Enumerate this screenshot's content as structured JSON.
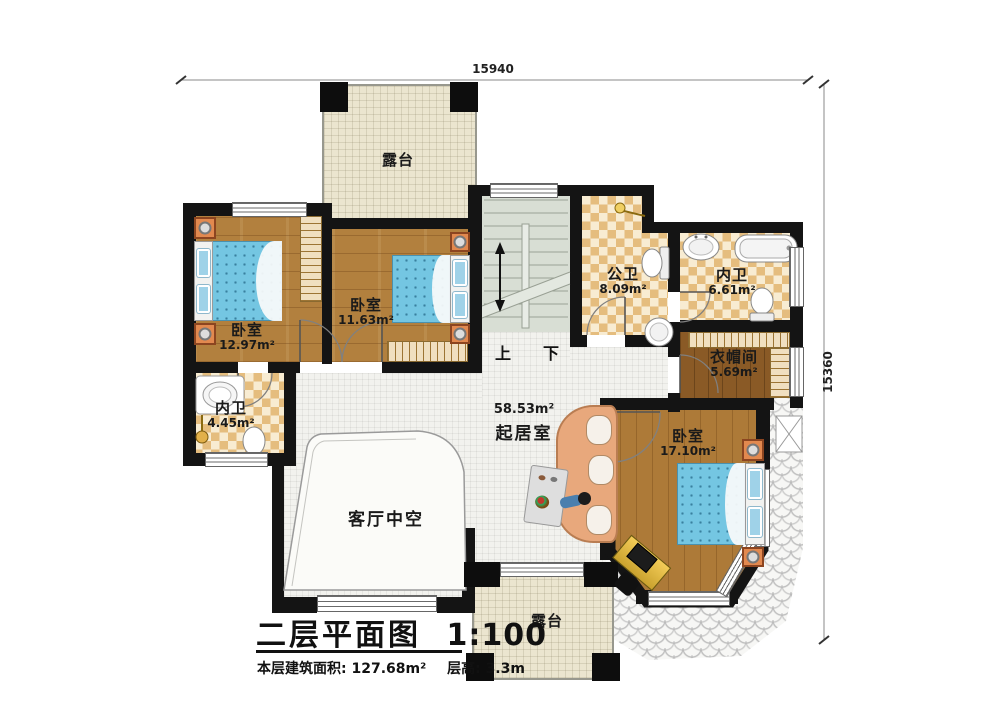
{
  "title_block": {
    "title": "二层平面图",
    "scale": "1:100",
    "building_area": "本层建筑面积: 127.68m²",
    "floor_height": "层高: 3.3m"
  },
  "dimensions": {
    "top_width": "15940",
    "right_height": "15360"
  },
  "stairs": {
    "up": "上",
    "down": "下"
  },
  "rooms": {
    "terrace_top": {
      "name": "露台"
    },
    "bedroom1": {
      "name": "卧室",
      "area": "12.97m²"
    },
    "bedroom2": {
      "name": "卧室",
      "area": "11.63m²"
    },
    "public_bath": {
      "name": "公卫",
      "area": "8.09m²"
    },
    "inner_bath": {
      "name": "内卫",
      "area": "6.61m²"
    },
    "closet": {
      "name": "衣帽间",
      "area": "5.69m²"
    },
    "small_bath": {
      "name": "内卫",
      "area": "4.45m²"
    },
    "living": {
      "name": "起居室",
      "area": "58.53m²"
    },
    "void": {
      "name": "客厅中空"
    },
    "bedroom3": {
      "name": "卧室",
      "area": "17.10m²"
    },
    "terrace_bottom": {
      "name": "露台"
    }
  },
  "colors": {
    "wall": "#141414",
    "wood_floor": "#b2803e",
    "closet_floor": "#8a5a26",
    "bath_tile": "#e5bd7e",
    "terrace_floor": "#ebe5cf",
    "stair_floor": "#d8ded4",
    "bed": "#74c6e2",
    "living_tile": "#f2f2ee"
  }
}
